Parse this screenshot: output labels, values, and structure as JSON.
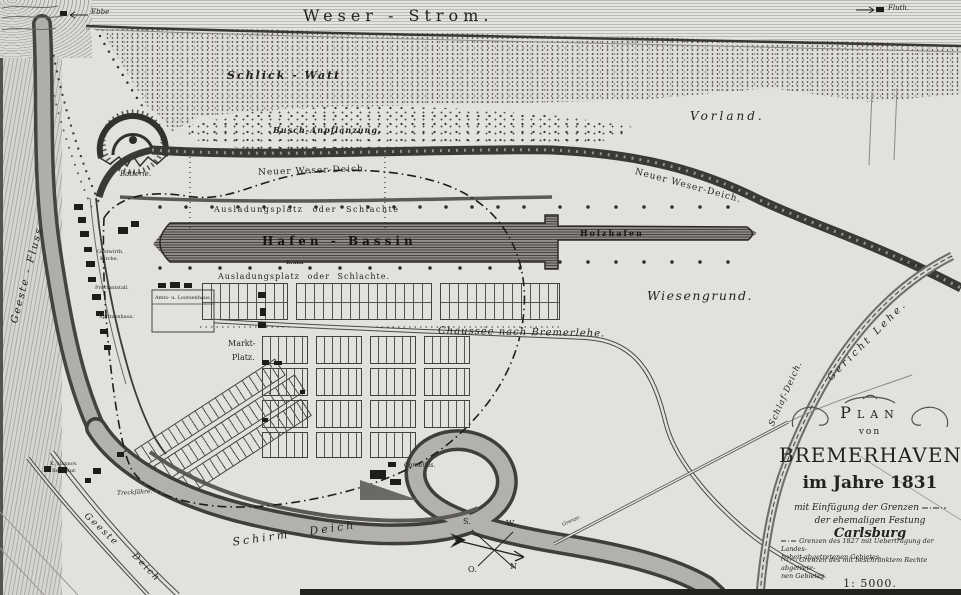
{
  "map": {
    "river_labels": {
      "weser_strom": "Weser - Strom.",
      "ebbe": "Ebbe",
      "fluth": "Fluth.",
      "geeste_fluss": "Geeste - Fluss"
    },
    "area_labels": {
      "schlick_watt": "Schlick - Watt",
      "busch": "Busch-Anpflanzung.",
      "vorland": "Vorland.",
      "wiesengrund": "Wiesengrund.",
      "gericht_lehe": "Gericht Lehe."
    },
    "dike_labels": {
      "neuer_weser_deich_west": "Neuer Weser-Deich.",
      "neuer_weser_deich_ost": "Neuer Weser-Deich.",
      "schirm_deich": "Schirm - Deich",
      "geeste_deich_1": "Geeste",
      "geeste_deich_2": "Deich",
      "schlaf_deich": "Schlaf-Deich."
    },
    "harbor_labels": {
      "ausladungsplatz_nord": "Ausladungsplatz oder Schlachte",
      "ausladungsplatz_sued": "Ausladungsplatz oder Schlachte.",
      "hafen_bassin": "Hafen - Bassin",
      "holzhafen": "Holzhafen",
      "krahn": "Krahn",
      "batterie": "Batterie."
    },
    "town_labels": {
      "markt_1": "Markt-",
      "markt_2": "Platz.",
      "amtshaus": "Amts- u. Lootsenhaus.",
      "gastwirth": "Gastwirth.",
      "kirche": "Kirche.",
      "proviantstall": "Proviantstall.",
      "spritzenhaus": "Spritzenhaus.",
      "cornelius": "Cornelius.",
      "treckfaehre": "Treckfähre.",
      "receptur_1": "K. Hannov.",
      "receptur_2": "Receptur."
    },
    "road_labels": {
      "chaussee": "Chaussée nach Bremerlehe.",
      "grenze_ost": "Grenze.",
      "grenze_sued": "Grenze."
    },
    "compass": {
      "s": "S.",
      "w": "W.",
      "o": "O.",
      "n": "N"
    }
  },
  "title_block": {
    "plan": "Plan",
    "von": "von",
    "name": "BREMERHAVEN",
    "year": "im Jahre 1831",
    "sub1": "mit Einfügung der Grenzen",
    "sub2": "der ehemaligen Festung",
    "sub2_em": "Carlsburg",
    "legend1_l1": "Grenzen des 1827 mit Uebertragung der Landes-",
    "legend1_l2": "hoheit abgetretenen Gebietes.",
    "legend2_l1": "Grenzen des mit beschränktem Rechte abgetrete-",
    "legend2_l2": "nen Gebietes.",
    "scale": "1: 5000."
  }
}
